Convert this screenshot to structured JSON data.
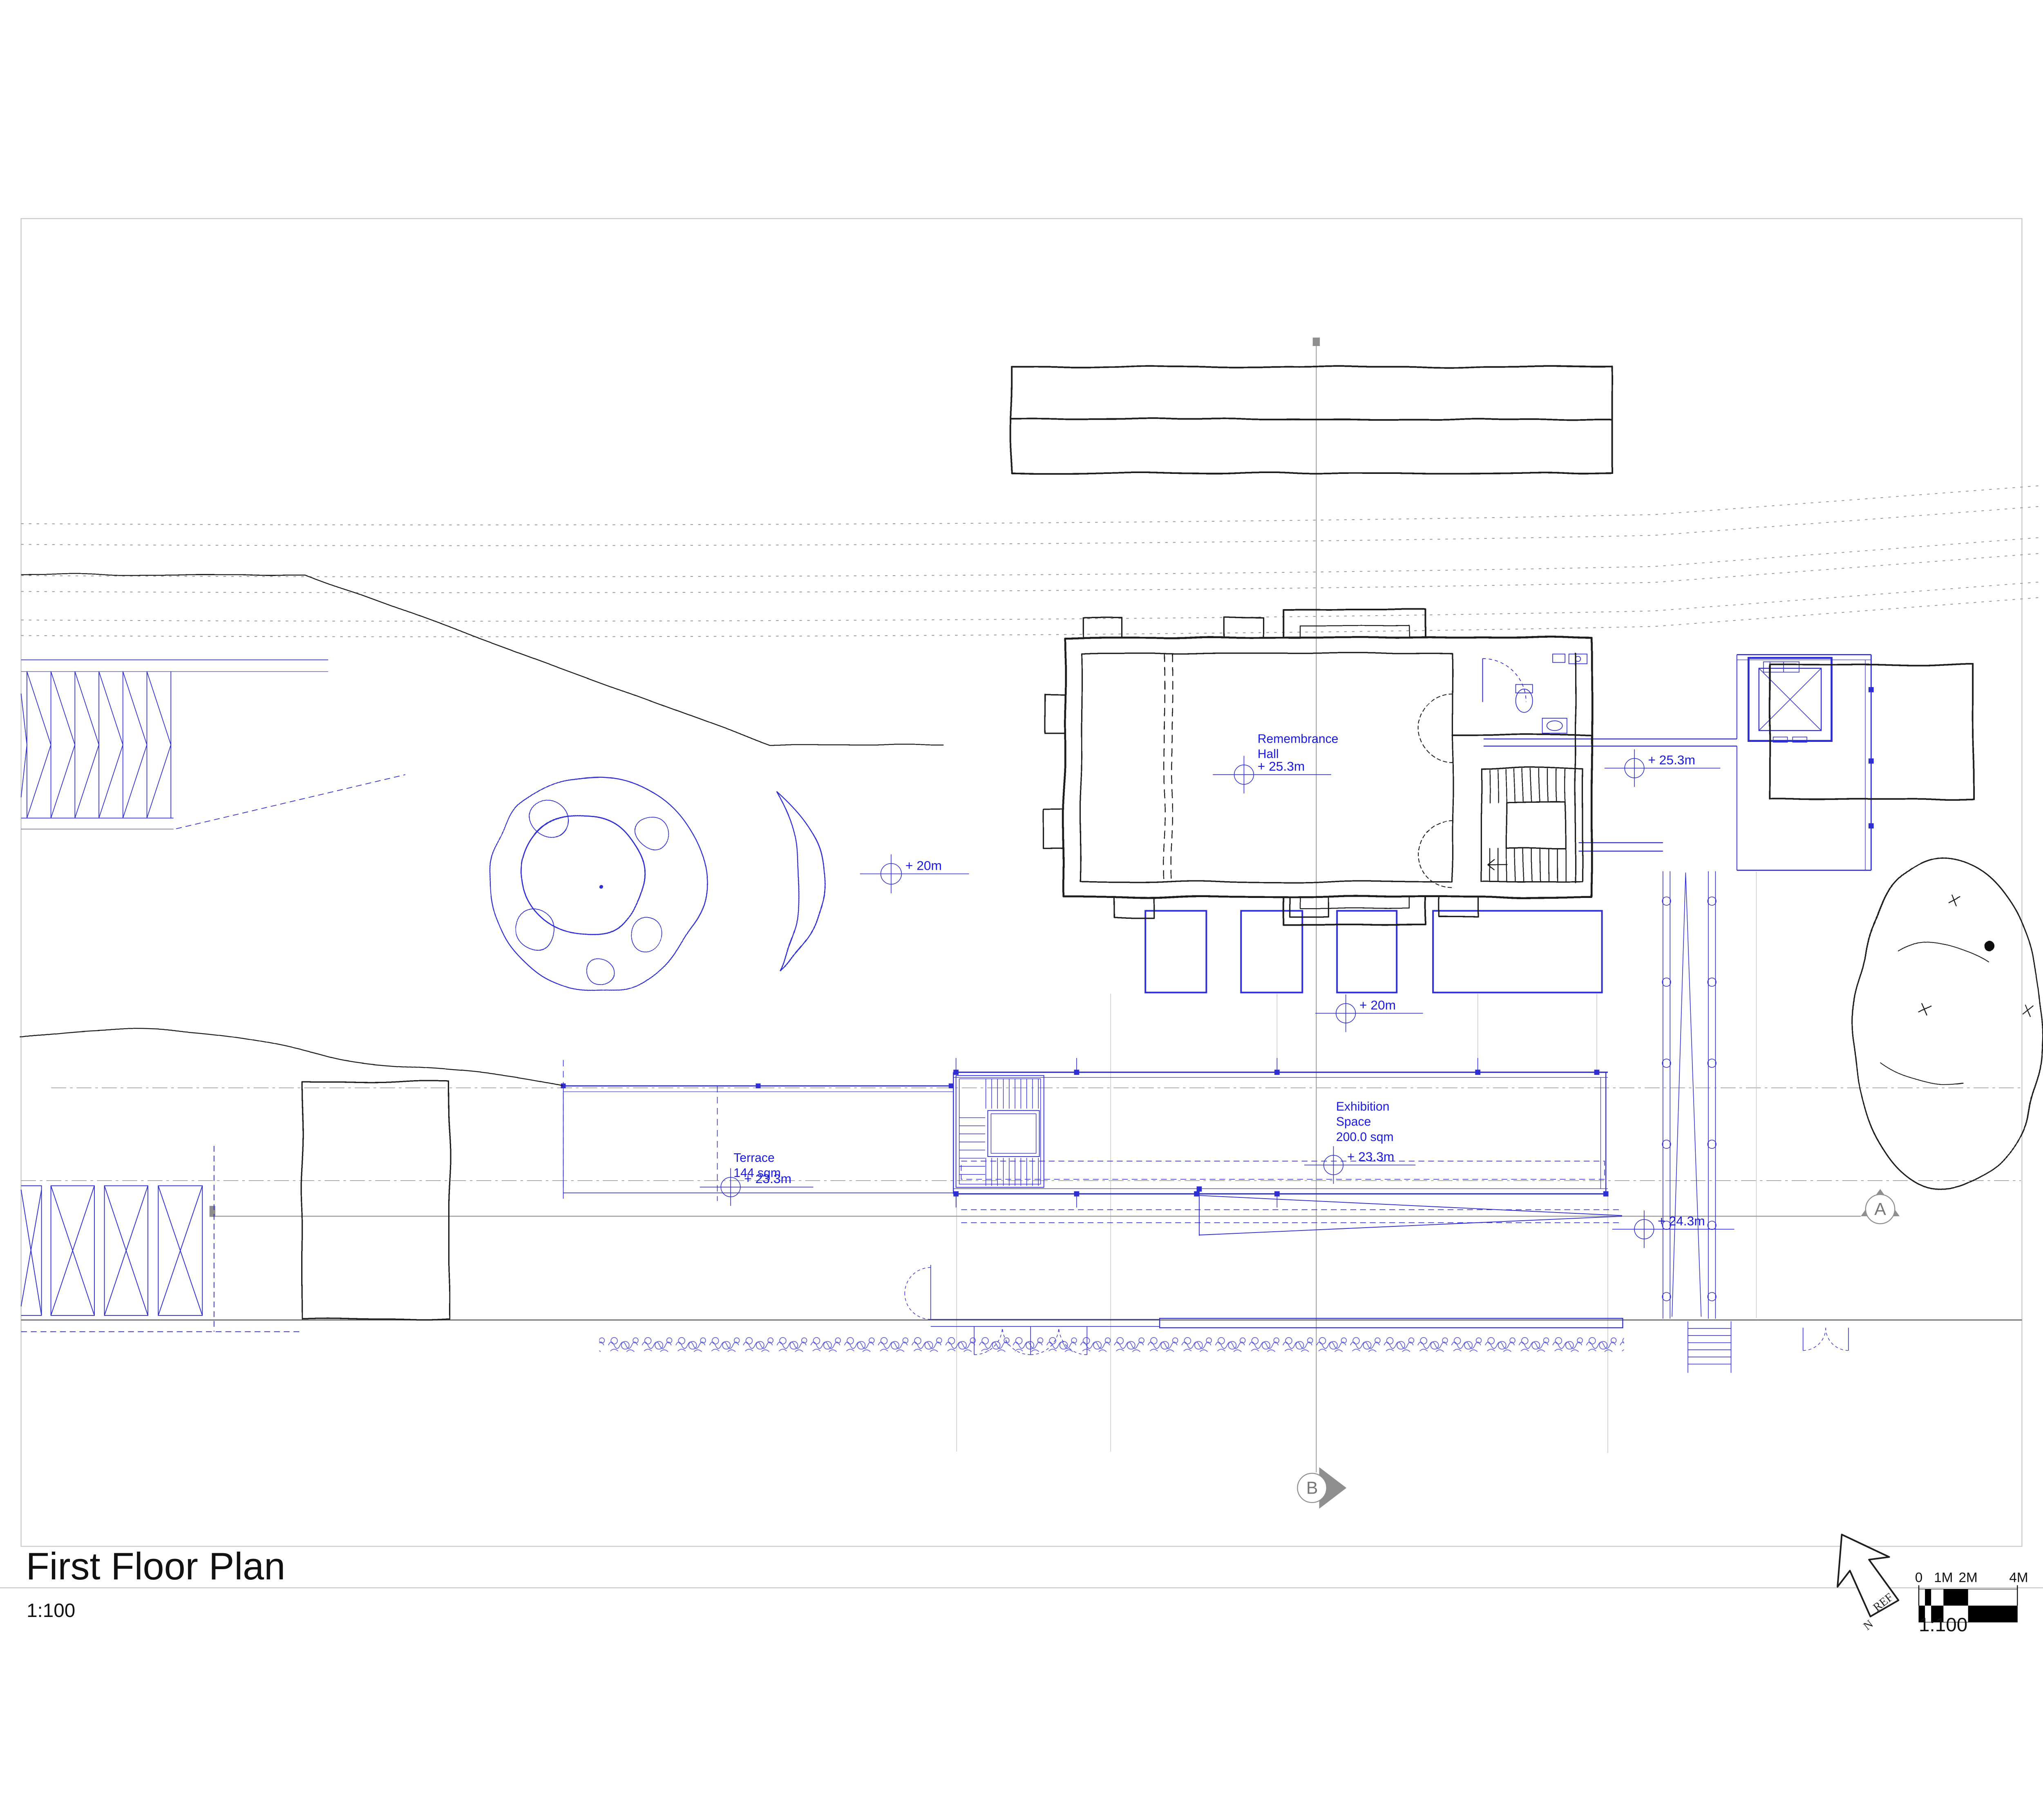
{
  "title": {
    "text": "First Floor Plan",
    "scale": "1:100"
  },
  "labels": {
    "remembrance_1": "Remembrance",
    "remembrance_2": "Hall",
    "remembrance_level": "+ 25.3m",
    "landing_level": "+ 25.3m",
    "exhibition_1": "Exhibition",
    "exhibition_2": "Space",
    "exhibition_3": "200.0 sqm",
    "exhibition_level": "+ 23.3m",
    "terrace_1": "Terrace",
    "terrace_2": "144 sqm",
    "terrace_level": "+ 23.3m",
    "garden_level": "+ 20m",
    "planter_level": "+ 20m",
    "walkway_level": "+ 24.3m"
  },
  "sections": {
    "a": "A",
    "b": "B"
  },
  "north_arrow": {
    "ref": "REF",
    "n": "N"
  },
  "scale_bar": {
    "ticks": [
      "0",
      "1M",
      "2M",
      "4M"
    ],
    "scale": "1:100"
  },
  "colors": {
    "cad_blue": "#2e2ed2",
    "text_blue": "#1a1ae0",
    "section_gray": "#9a9a9a",
    "sketch_black": "#1c1c1c"
  }
}
